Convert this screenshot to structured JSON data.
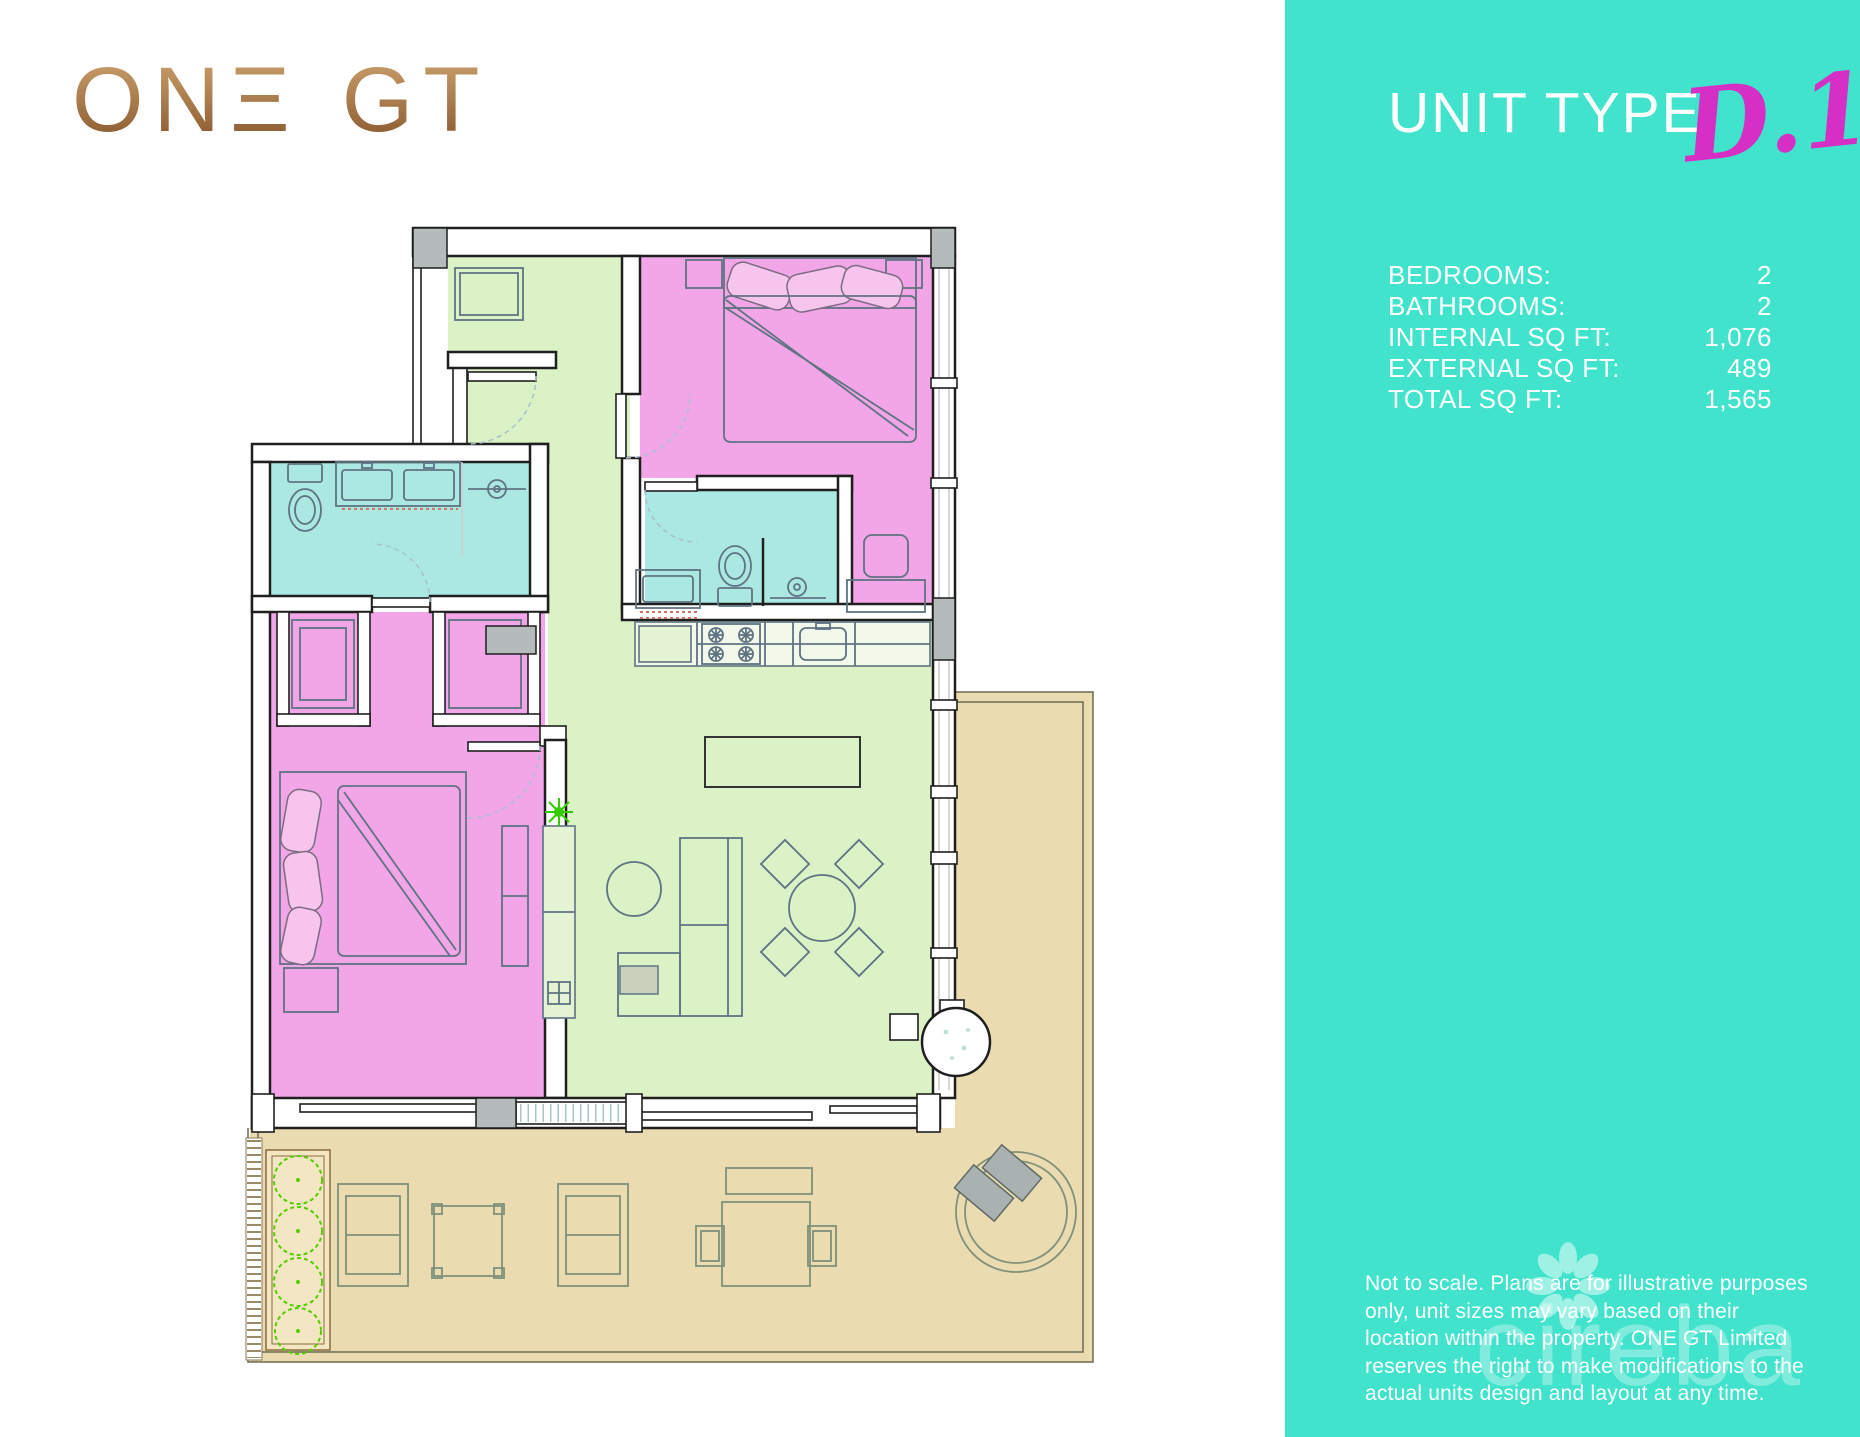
{
  "logo": {
    "on": "ON",
    "e": "Ξ",
    "bar": "|",
    "gt": "GT"
  },
  "sidebar": {
    "title": "UNIT TYPE",
    "unit_code": "D.1",
    "specs": [
      {
        "label": "BEDROOMS:",
        "value": "2"
      },
      {
        "label": "BATHROOMS:",
        "value": "2"
      },
      {
        "label": "INTERNAL SQ FT:",
        "value": "1,076"
      },
      {
        "label": "EXTERNAL SQ FT:",
        "value": "489"
      },
      {
        "label": "TOTAL SQ FT:",
        "value": "1,565"
      }
    ],
    "disclaimer": "Not to scale. Plans are for illustrative purposes only, unit sizes may vary based on their location within the property. ONE GT Limited reserves the right to make modifications to the actual units design and layout at any time.",
    "watermark": "cireba"
  },
  "colors": {
    "teal": "#41E3CC",
    "magenta": "#D62FC6",
    "gold_light": "#C99F6B",
    "gold_dark": "#85552B",
    "room_pink": "#F2A6E8",
    "room_green": "#DBF1C6",
    "room_blue": "#ABE8E1",
    "terrace_tan": "#EBDBB0",
    "wall_dark": "#1F1F1F",
    "furniture_stroke": "#5F7383",
    "terrace_stroke": "#7F917B",
    "gray_fill": "#B5BBBB",
    "glass_gray": "#C9CFCF",
    "bush_green": "#55CC00",
    "arc_blue": "#A8BFD0"
  }
}
